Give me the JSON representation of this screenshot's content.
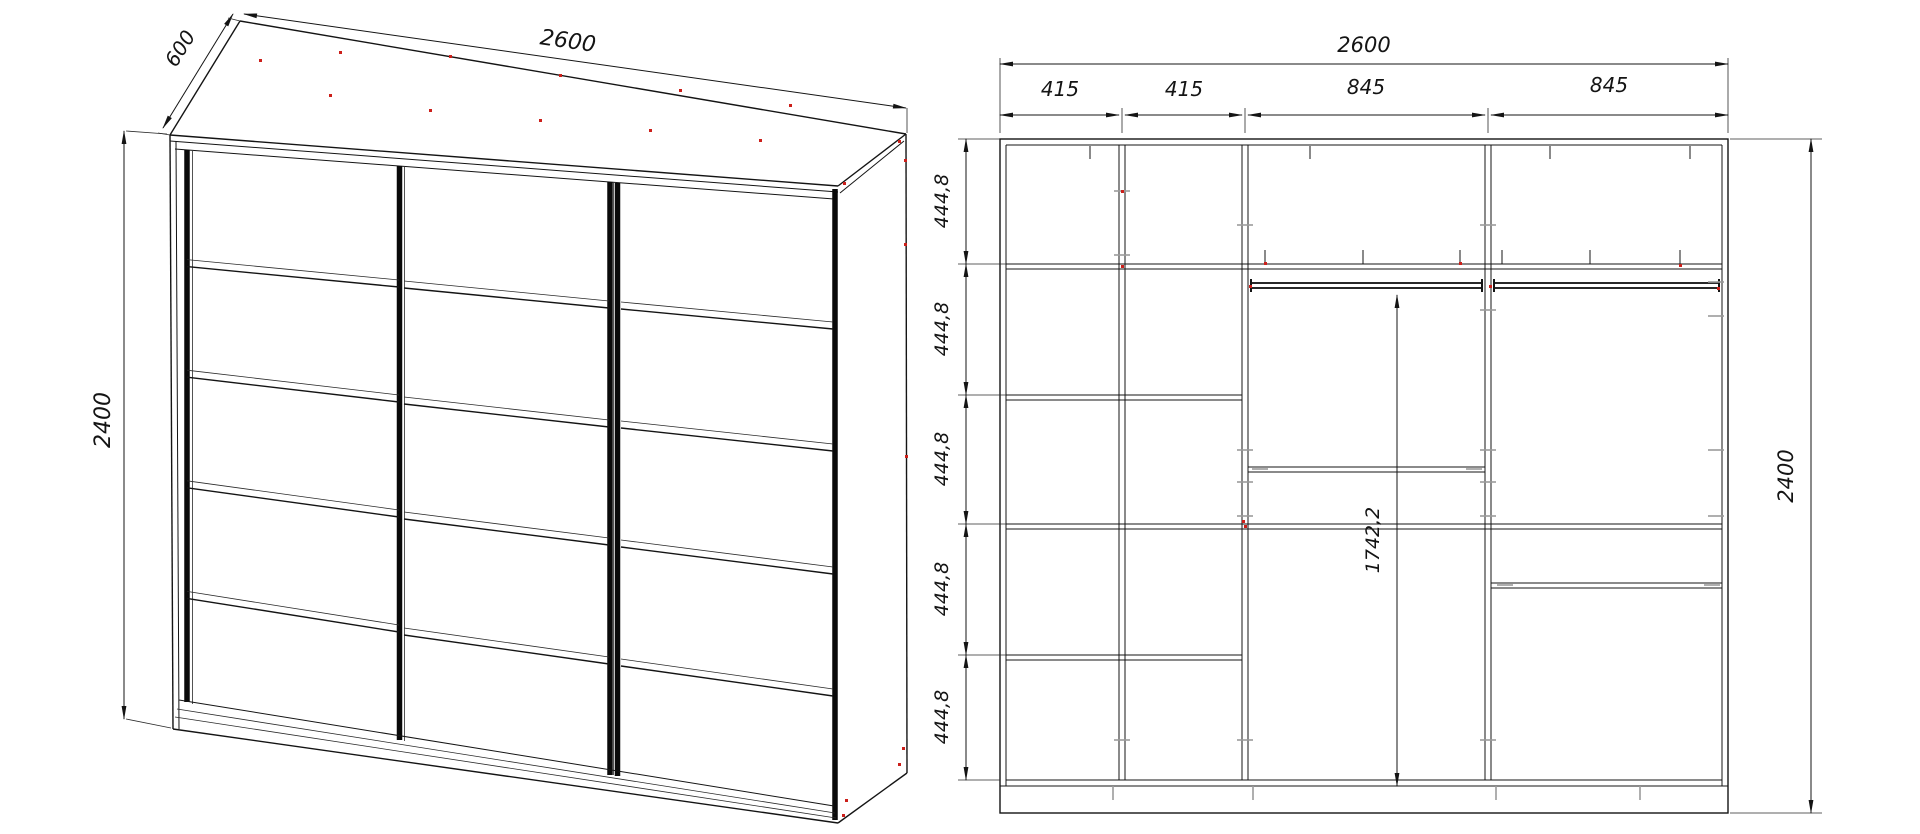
{
  "document": {
    "type": "furniture-technical-drawing",
    "subject": "sliding-door wardrobe: perspective view and internal front elevation"
  },
  "left_view": {
    "name": "wardrobe-perspective-view",
    "depth_label": "600",
    "width_label": "2600",
    "height_label": "2400",
    "door_count": 3,
    "door_rows": 5
  },
  "right_view": {
    "name": "wardrobe-front-elevation",
    "total_width_label": "2600",
    "section_labels": [
      "415",
      "415",
      "845",
      "845"
    ],
    "row_height_labels": [
      "444,8",
      "444,8",
      "444,8",
      "444,8",
      "444,8"
    ],
    "hanging_height_label": "1742,2",
    "total_height_label": "2400"
  },
  "colors": {
    "line": "#141414",
    "connector_tick_gray": "#9b9b9b",
    "dowel_mark_red": "#cc1f1a",
    "background": "#ffffff"
  }
}
